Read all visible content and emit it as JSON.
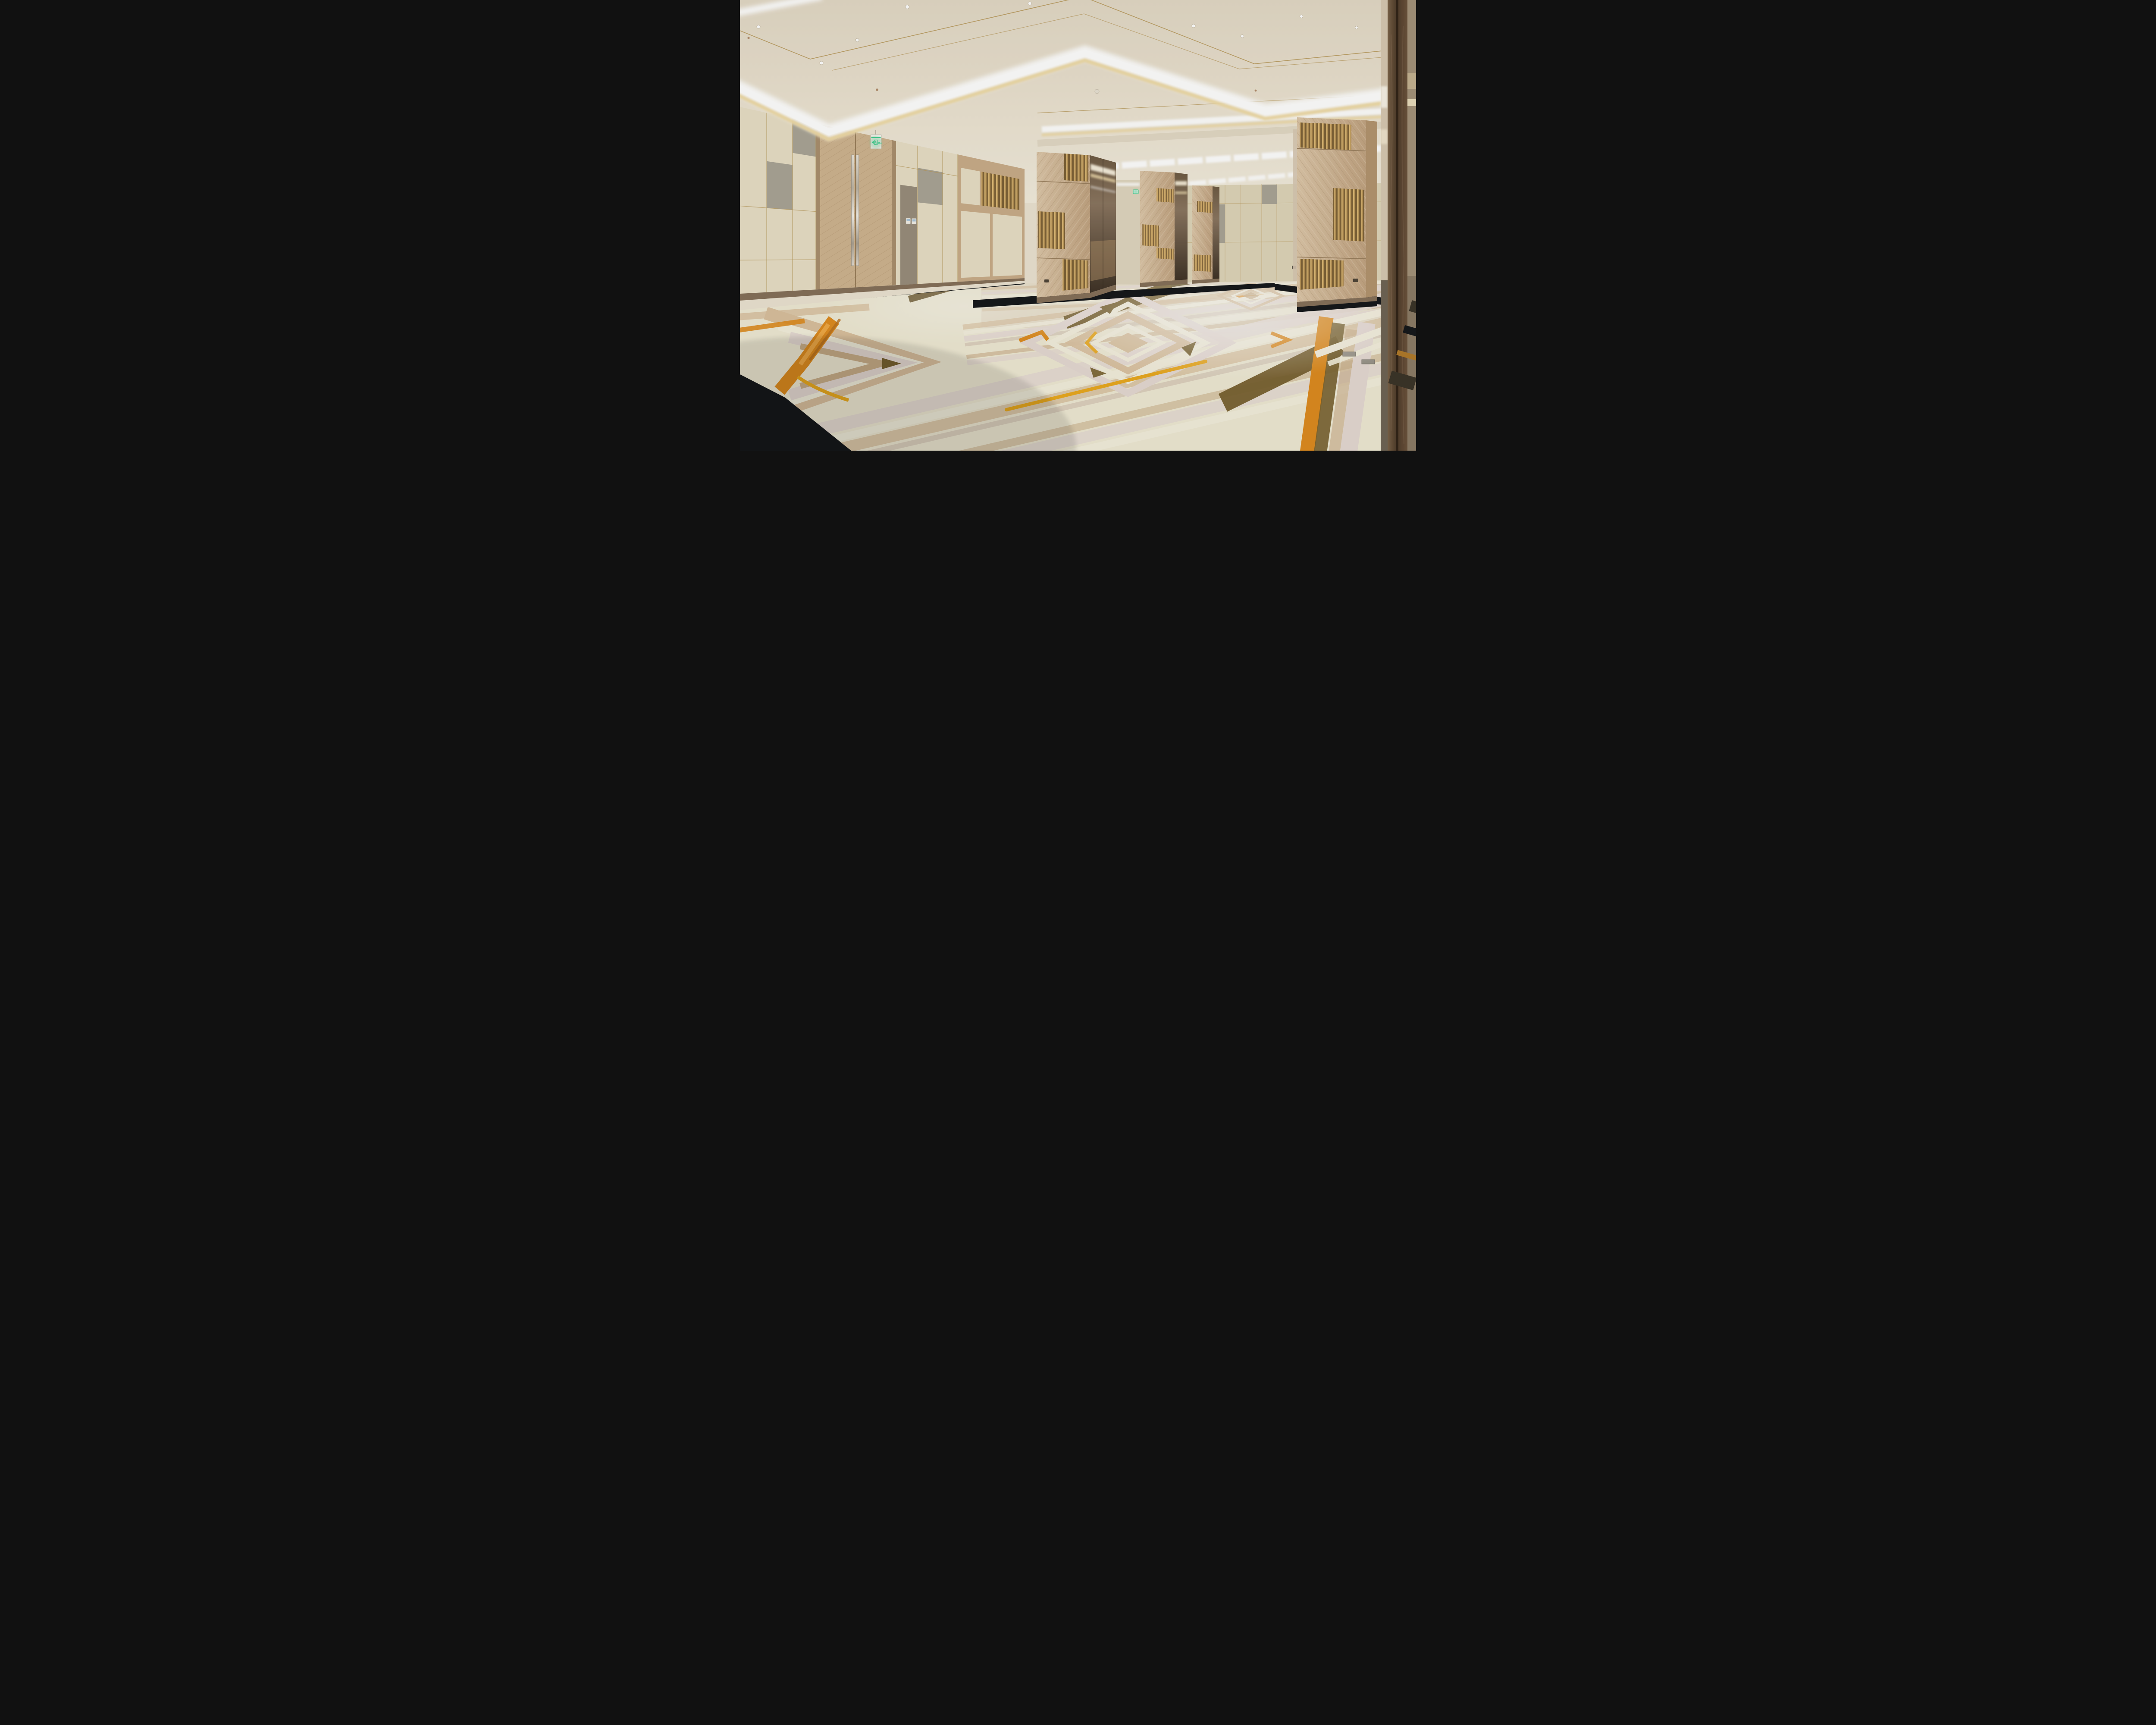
{
  "meta": {
    "domain": "interior-photograph",
    "room_type": "hotel ballroom / banquet hall",
    "style": "contemporary warm neutrals, cove-lit coffered ceiling, chevron wood panelling, geometric carpet",
    "people_present": 0,
    "furniture_present": 0
  },
  "signage": {
    "exit_label": "EXIT",
    "exit_mirrored": true,
    "exit_sign_count": 2
  },
  "devices": {
    "thermostats": 2,
    "wall_outlets": 3,
    "floor_outlets": 2,
    "downlights": 11,
    "sprinklers": 3,
    "smoke_detectors": 1,
    "door_pulls": 2
  },
  "palette": {
    "ceiling-base": "#EBE3D2",
    "ceiling-far": "#DFD4C0",
    "gold-trim": "#B8995C",
    "cove-white": "#FFFFFF",
    "cove-amber": "#EFD9A2",
    "fascia-shade": "#D8CCB6",
    "wall-cream": "#E8DFC6",
    "wall-cream-dark": "#DFD5B9",
    "wall-gray": "#A9A496",
    "wall-taupe": "#988D7C",
    "wood-frame": "#A98F6E",
    "wood-light": "#D8C2A3",
    "wood-mid": "#C9AD8A",
    "wood-dark": "#B3946F",
    "gold-slat-a": "#DDB873",
    "gold-slat-b": "#7E6238",
    "door-wood": "#CFB490",
    "mirror-hi": "#D7C8B2",
    "mirror-lo": "#3E3226",
    "bronze": "#8A7560",
    "walnut-a": "#75604A",
    "walnut-b": "#3F2F20",
    "plinth": "#85705A",
    "carpet-cream": "#EFE9D4",
    "carpet-ivory": "#F3EEDC",
    "carpet-tan": "#D9C09E",
    "carpet-tan-dark": "#C9AE88",
    "carpet-blush": "#E5D9D3",
    "carpet-taupe": "#CBBAA9",
    "carpet-orange": "#DE8B1F",
    "carpet-orange-lite": "#F0A844",
    "carpet-amber": "#E9A81E",
    "carpet-brown": "#77602F",
    "carpet-black": "#15171A",
    "exit-green": "#3BCB8C",
    "device-screen": "#A9C4D8",
    "back-wash": "#E0D6C0",
    "metal-plate": "#9A958B"
  }
}
